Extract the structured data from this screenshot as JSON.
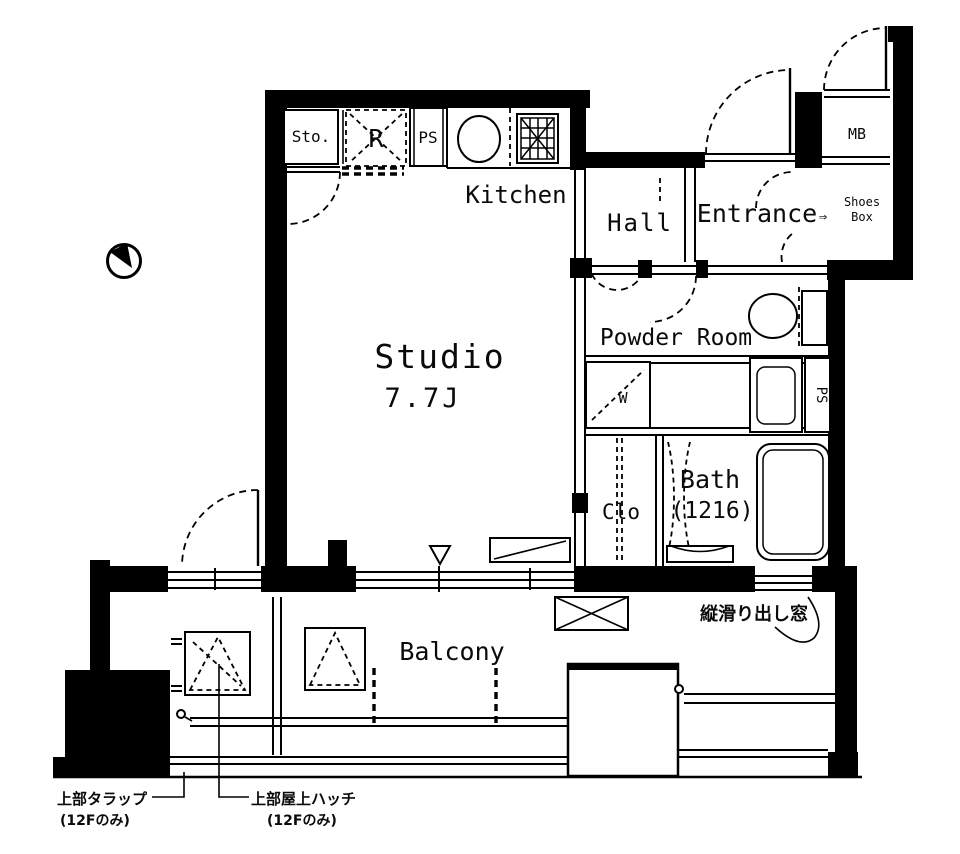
{
  "plan": {
    "unit_type": "Studio apartment floor plan",
    "rooms": {
      "studio": {
        "label": "Studio",
        "size": "7.7J"
      },
      "kitchen": {
        "label": "Kitchen"
      },
      "hall": {
        "label": "Hall"
      },
      "entrance": {
        "label": "Entrance",
        "arrow": "⇒"
      },
      "powder_room": {
        "label": "Powder Room"
      },
      "bath": {
        "label": "Bath",
        "size": "(1216)"
      },
      "closet": {
        "label": "Clo"
      },
      "balcony": {
        "label": "Balcony"
      }
    },
    "compartments": {
      "storage": "Sto.",
      "refrigerator": "R",
      "pipe_space_top": "PS",
      "pipe_space_side": "PS",
      "meter_box": "MB",
      "shoes_box_line1": "Shoes",
      "shoes_box_line2": "Box",
      "washer": "W"
    },
    "annotations": {
      "window_note": "縦滑り出し窓",
      "ladder_note_line1": "上部タラップ",
      "ladder_note_line2": "(12Fのみ)",
      "hatch_note_line1": "上部屋上ハッチ",
      "hatch_note_line2": "(12Fのみ)"
    },
    "colors": {
      "line": "#000000",
      "background": "#ffffff"
    }
  }
}
